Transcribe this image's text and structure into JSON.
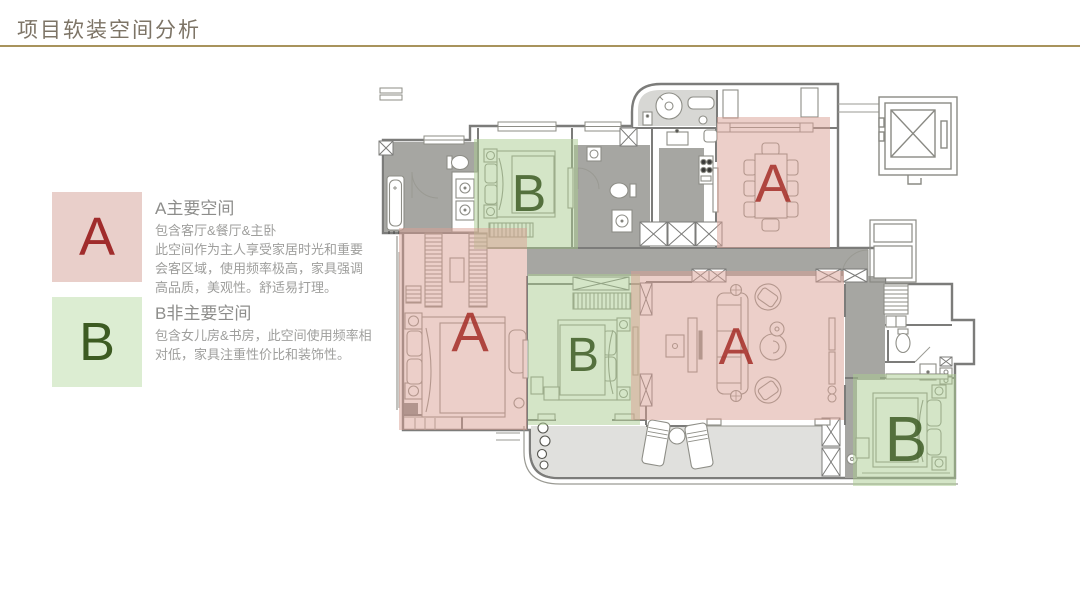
{
  "page": {
    "title": "项目软装空间分析"
  },
  "legend": {
    "items": [
      {
        "letter": "A",
        "title": "A主要空间",
        "body": "包含客厅&餐厅&主卧\n此空间作为主人享受家居时光和重要\n会客区域，使用频率极高，家具强调\n高品质，美观性。舒适易打理。",
        "box_color": "#e9cfca",
        "letter_color": "#a02c2c"
      },
      {
        "letter": "B",
        "title": "B非主要空间",
        "body": "包含女儿房&书房，此空间使用频率相\n对低，家具注重性价比和装饰性。",
        "box_color": "#dcedd2",
        "letter_color": "#3c5b22"
      }
    ]
  },
  "floorplan": {
    "colors": {
      "zoneA": "#d9a093",
      "zoneB": "#a9cb8f",
      "letterA": "#a52e27",
      "letterB": "#3e5c26"
    },
    "zones": [
      {
        "id": "bedroom-top",
        "type": "B",
        "label": "B",
        "x": 474,
        "y": 139,
        "w": 104,
        "h": 110,
        "fs": 52,
        "lx": 529,
        "ly": 211
      },
      {
        "id": "dining",
        "type": "A",
        "label": "A",
        "x": 717,
        "y": 117,
        "w": 113,
        "h": 131,
        "fs": 54,
        "lx": 773,
        "ly": 202
      },
      {
        "id": "master-bedroom",
        "type": "A",
        "label": "A",
        "x": 399,
        "y": 228,
        "w": 128,
        "h": 202,
        "fs": 56,
        "lx": 470,
        "ly": 351
      },
      {
        "id": "bedroom-middle",
        "type": "B",
        "label": "B",
        "x": 528,
        "y": 274,
        "w": 112,
        "h": 151,
        "fs": 48,
        "lx": 583,
        "ly": 371
      },
      {
        "id": "living-room",
        "type": "A",
        "label": "A",
        "x": 631,
        "y": 271,
        "w": 213,
        "h": 149,
        "fs": 52,
        "lx": 736,
        "ly": 364
      },
      {
        "id": "bedroom-right",
        "type": "B",
        "label": "B",
        "x": 853,
        "y": 374,
        "w": 103,
        "h": 112,
        "fs": 64,
        "lx": 906,
        "ly": 461
      }
    ]
  }
}
